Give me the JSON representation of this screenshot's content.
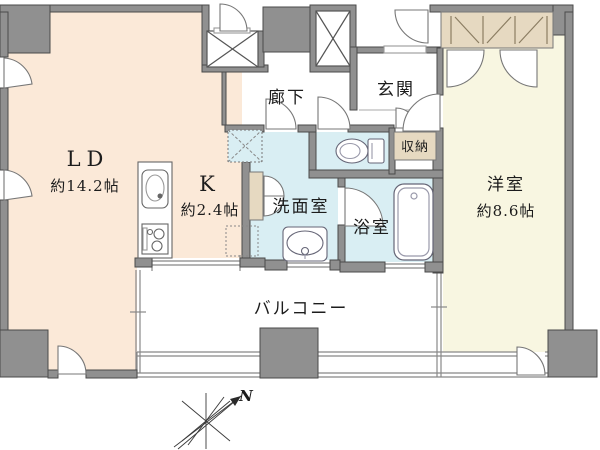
{
  "floorplan": {
    "rooms": {
      "ld": {
        "name": "LD",
        "size": "約14.2帖"
      },
      "kitchen": {
        "name": "K",
        "size": "約2.4帖"
      },
      "hallway": {
        "name": "廊下"
      },
      "entrance": {
        "name": "玄関"
      },
      "entrance_storage": {
        "name": "収納"
      },
      "washroom": {
        "name": "洗面室"
      },
      "bathroom": {
        "name": "浴室"
      },
      "western_room": {
        "name": "洋室",
        "size": "約8.6帖"
      },
      "balcony": {
        "name": "バルコニー"
      }
    },
    "compass": {
      "north_label": "N"
    },
    "colors": {
      "room_peach": "#fbe9d8",
      "room_cream": "#f8f6e1",
      "room_water": "#d9eef3",
      "closet_beige": "#e6d9c1",
      "wall_gray": "#909090",
      "line_gray": "#777777"
    },
    "icons": [
      {
        "name": "kitchen-sink-icon"
      },
      {
        "name": "stove-icon"
      },
      {
        "name": "refrigerator-space-icon"
      },
      {
        "name": "washing-machine-pan-icon"
      },
      {
        "name": "toilet-icon"
      },
      {
        "name": "washbasin-icon"
      },
      {
        "name": "bathtub-icon"
      },
      {
        "name": "closet-cross-icon"
      },
      {
        "name": "elevator-shaft-icon"
      },
      {
        "name": "compass-icon"
      }
    ]
  }
}
